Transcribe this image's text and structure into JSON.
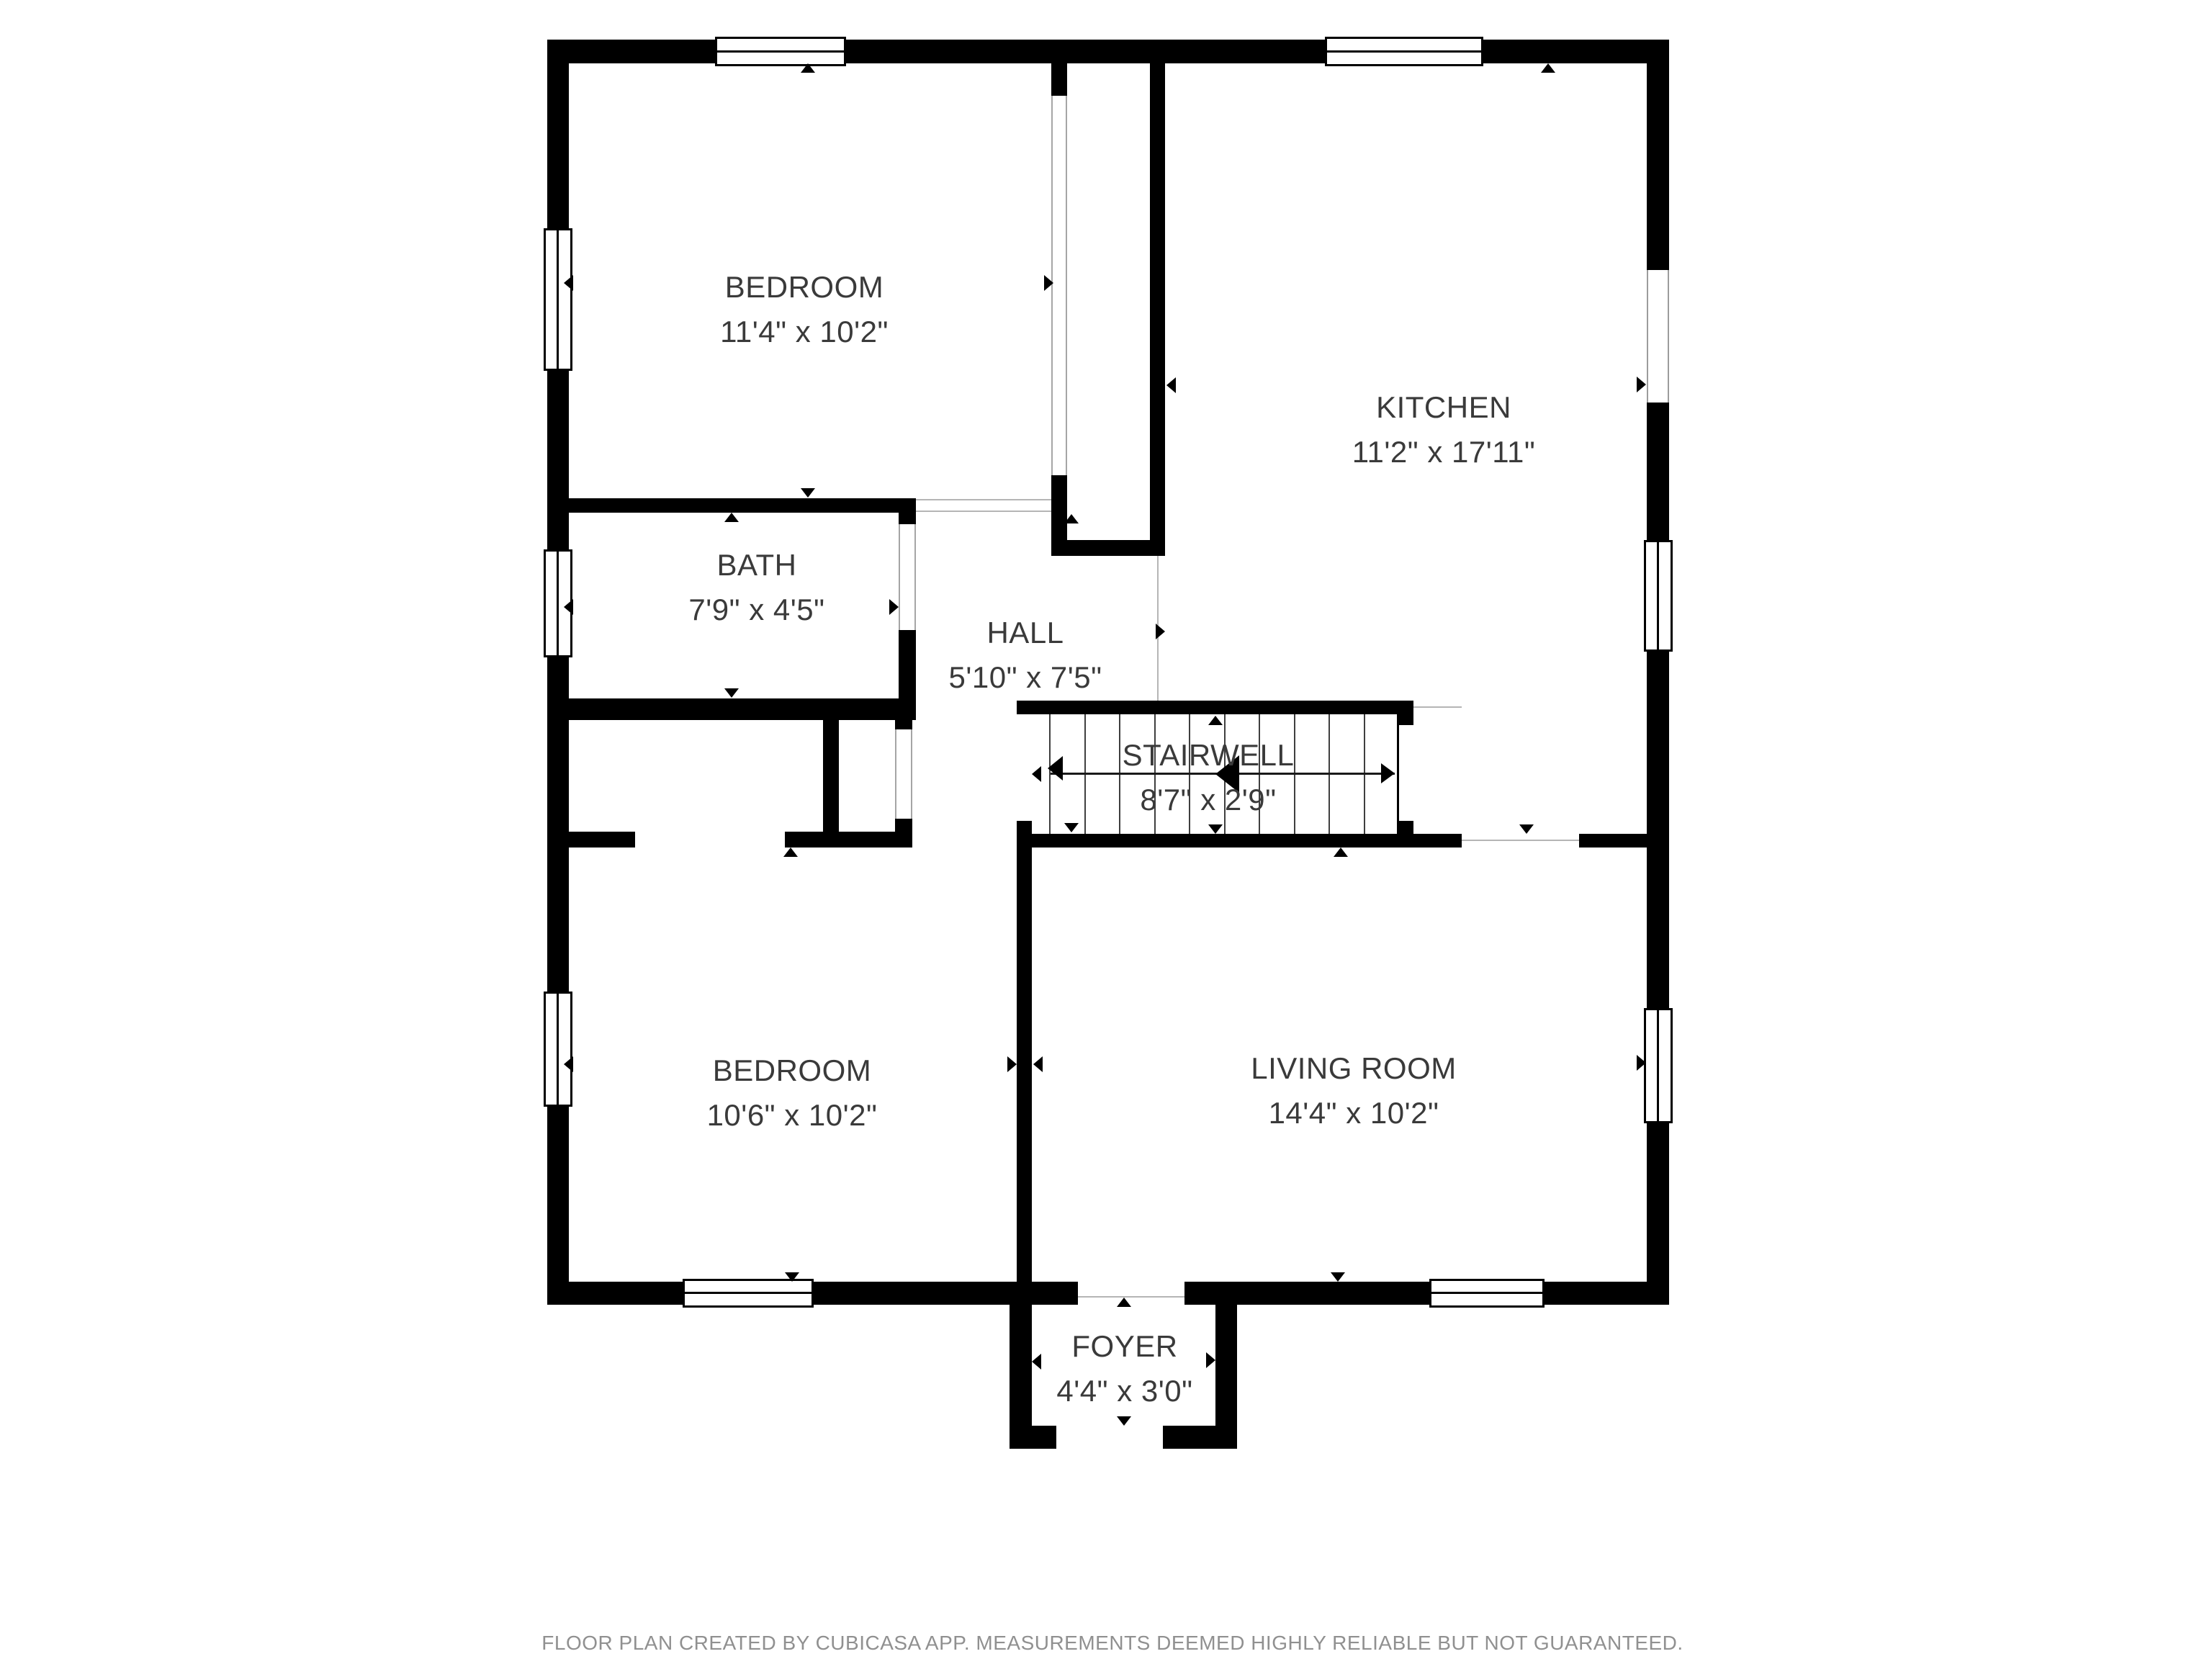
{
  "meta": {
    "type": "floor-plan",
    "creator_note_visible": true
  },
  "colors": {
    "wall": "#000000",
    "background": "#ffffff",
    "label_text": "#3a3a3a",
    "footer_text": "#909090",
    "hairline": "#b5b5b5"
  },
  "icons": {
    "door-marker": "small black triangle",
    "stair-direction-arrow": "double-headed horizontal arrow"
  },
  "rooms": [
    {
      "id": "bedroom-1",
      "name": "BEDROOM",
      "dims": "11'4\" x 10'2\""
    },
    {
      "id": "kitchen",
      "name": "KITCHEN",
      "dims": "11'2\" x 17'11\""
    },
    {
      "id": "bath",
      "name": "BATH",
      "dims": "7'9\" x 4'5\""
    },
    {
      "id": "hall",
      "name": "HALL",
      "dims": "5'10\" x 7'5\""
    },
    {
      "id": "stairwell",
      "name": "STAIRWELL",
      "dims": "8'7\" x 2'9\""
    },
    {
      "id": "bedroom-2",
      "name": "BEDROOM",
      "dims": "10'6\" x 10'2\""
    },
    {
      "id": "living-room",
      "name": "LIVING ROOM",
      "dims": "14'4\" x 10'2\""
    },
    {
      "id": "foyer",
      "name": "FOYER",
      "dims": "4'4\" x 3'0\""
    }
  ],
  "footer": {
    "text": "FLOOR PLAN CREATED BY CUBICASA APP. MEASUREMENTS DEEMED HIGHLY RELIABLE BUT NOT GUARANTEED."
  }
}
